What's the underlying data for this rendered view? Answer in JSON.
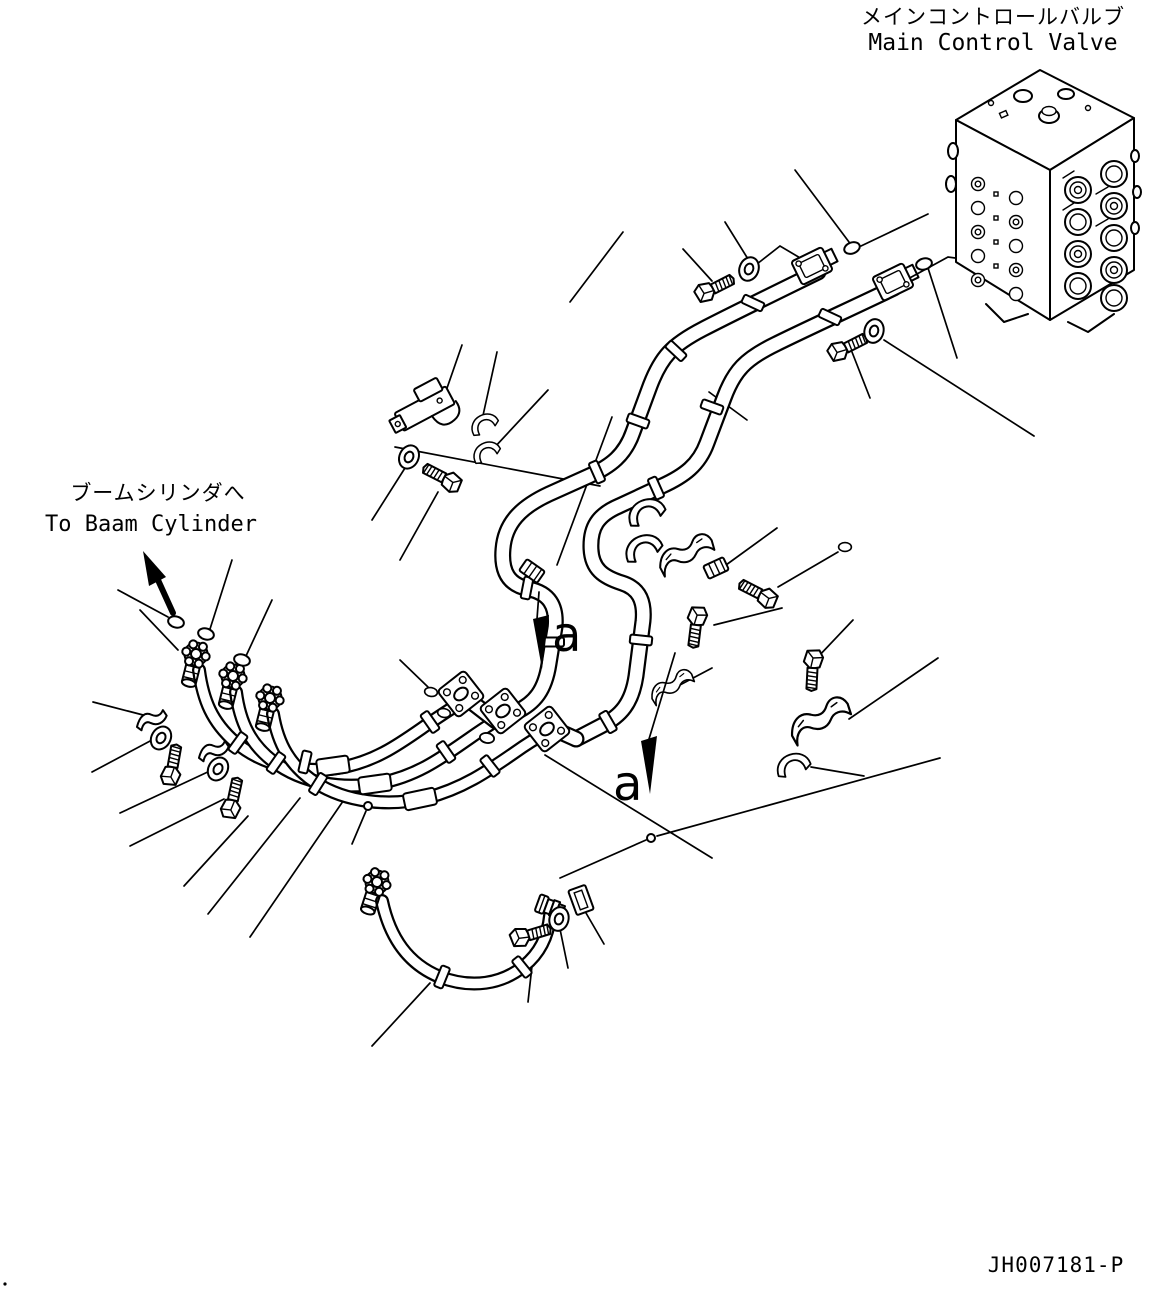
{
  "diagram": {
    "title_jp": "メインコントロールバルブ",
    "title_en": "Main Control Valve",
    "destination_jp": "ブームシリンダへ",
    "destination_en": "To Baam Cylinder",
    "section_marker_a1": "a",
    "section_marker_a2": "a",
    "drawing_number": "JH007181-P",
    "colors": {
      "line": "#000000",
      "background": "#ffffff"
    }
  }
}
